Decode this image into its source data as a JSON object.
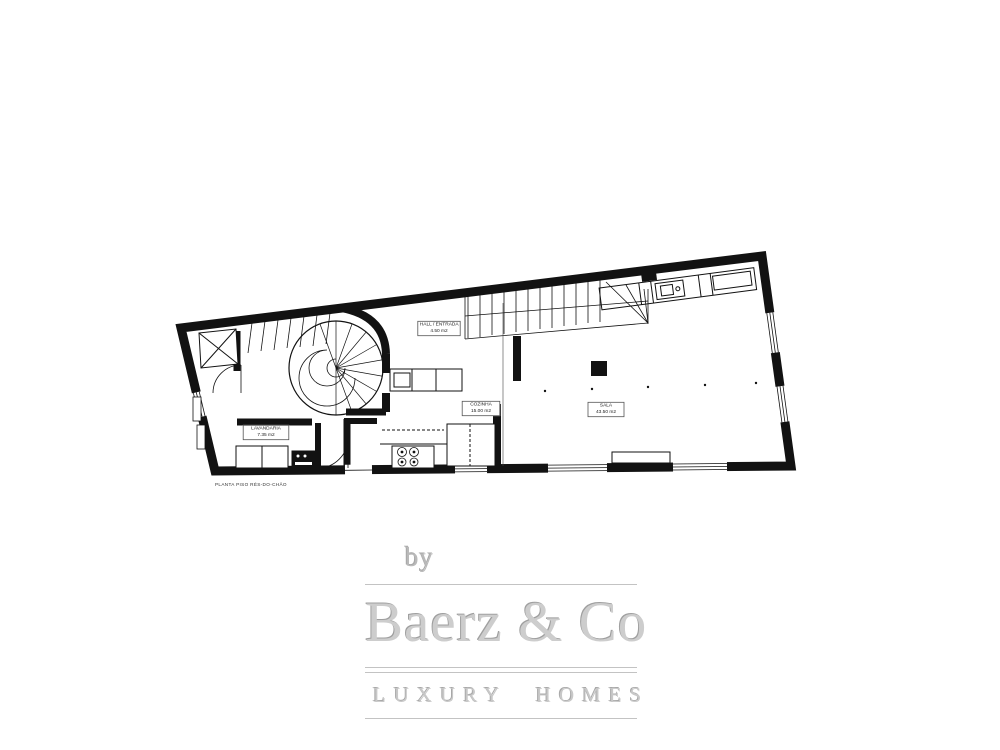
{
  "floor_plan": {
    "caption": "PLANTA PISO RÉS-DO-CHÃO",
    "rooms": {
      "hall": {
        "name": "HALL / ENTRADA",
        "area": "4.50 m2"
      },
      "cozinha": {
        "name": "COZINHA",
        "area": "15.00 m2"
      },
      "sala": {
        "name": "SALA",
        "area": "43.50 m2"
      },
      "lavandaria": {
        "name": "LAVANDARIA",
        "area": "7.35 m2"
      }
    }
  },
  "logo": {
    "by": "by",
    "brand": "Baerz & Co",
    "tagline": "LUXURY HOMES"
  },
  "colors": {
    "ink": "#121212",
    "logo_gray": "#c8c8c8",
    "background": "#ffffff"
  }
}
